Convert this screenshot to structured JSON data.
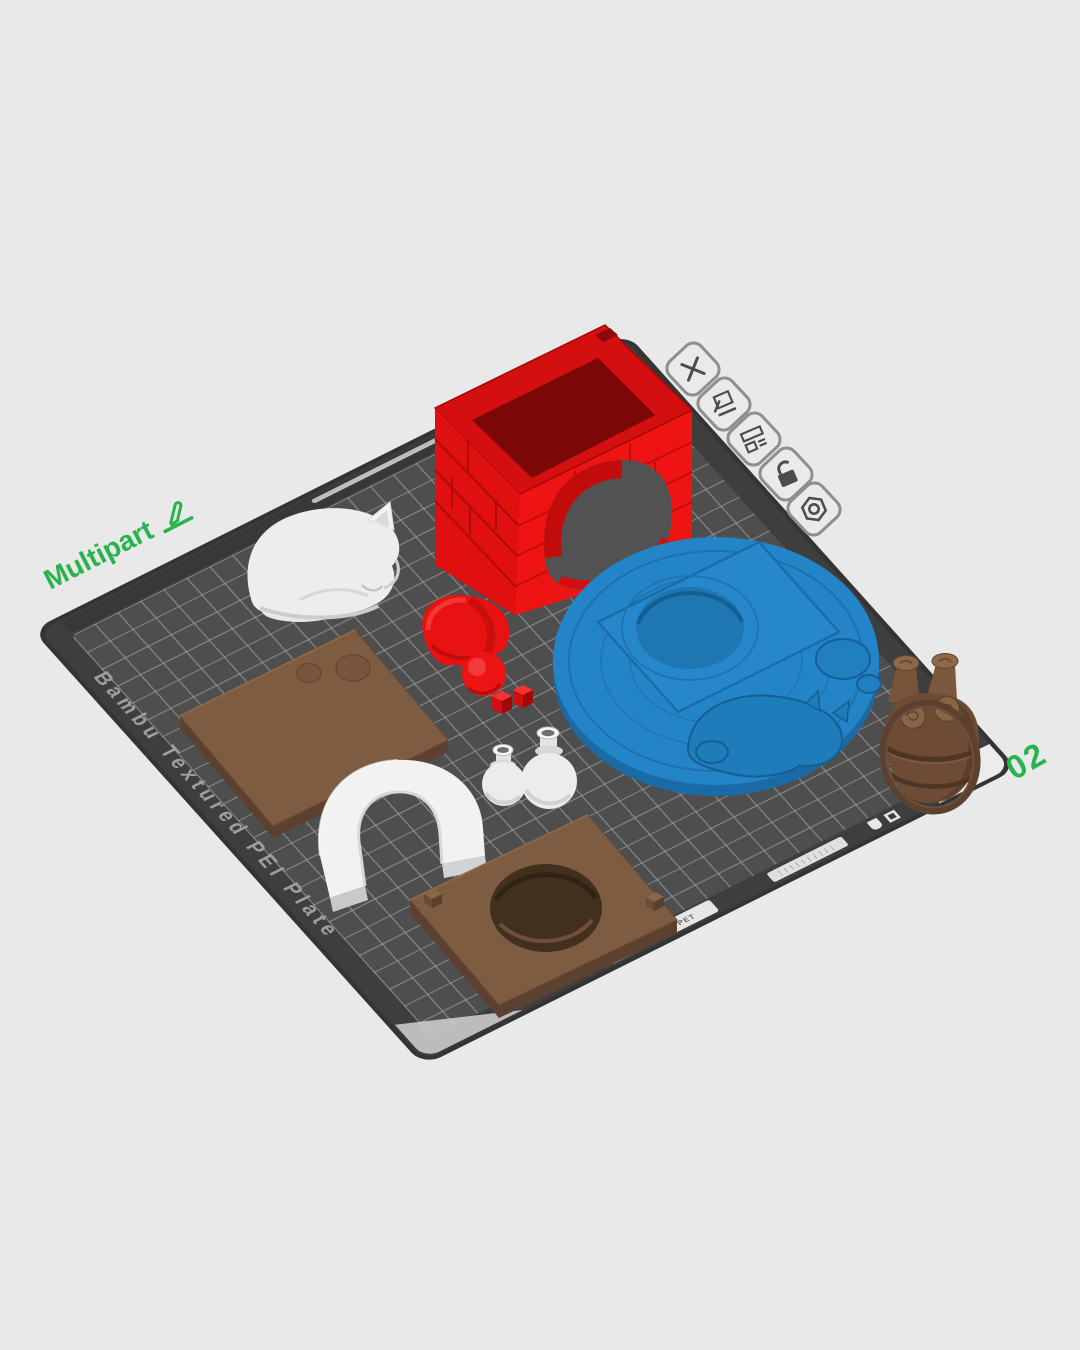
{
  "viewport": {
    "background_color": "#e9e9e9",
    "plate": {
      "label": "Multipart",
      "number": "02",
      "name_text": "Bambu Textured PEI Plate",
      "marking_text": "PLA PETG PET",
      "surface_color": "#4e4e4e",
      "grid_line_color": "#a5a5a5",
      "accent_green": "#2ab24d"
    },
    "plate_toolbar": {
      "items": [
        {
          "name": "delete-plate",
          "icon": "x-icon"
        },
        {
          "name": "edit-plate-name",
          "icon": "pencil-plate-icon"
        },
        {
          "name": "arrange-plate",
          "icon": "layout-icon"
        },
        {
          "name": "lock-plate",
          "icon": "unlocked-padlock-icon"
        },
        {
          "name": "plate-settings",
          "icon": "hex-gear-icon"
        }
      ]
    },
    "models": [
      {
        "name": "brick-fireplace",
        "color": "#e11111"
      },
      {
        "name": "sleeping-cat",
        "color": "#ededed"
      },
      {
        "name": "santa-hat",
        "color": "#e81212"
      },
      {
        "name": "dice-pair",
        "color": "#d91010"
      },
      {
        "name": "engraved-round-base",
        "color": "#2484c8"
      },
      {
        "name": "flat-plate-two-recesses",
        "color": "#7d5c42"
      },
      {
        "name": "flat-plate-round-hole",
        "color": "#7d5c42"
      },
      {
        "name": "arch",
        "color": "#f2f2f2"
      },
      {
        "name": "two-jugs",
        "color": "#ececec"
      },
      {
        "name": "log-basket",
        "color": "#6d4b34"
      }
    ]
  }
}
